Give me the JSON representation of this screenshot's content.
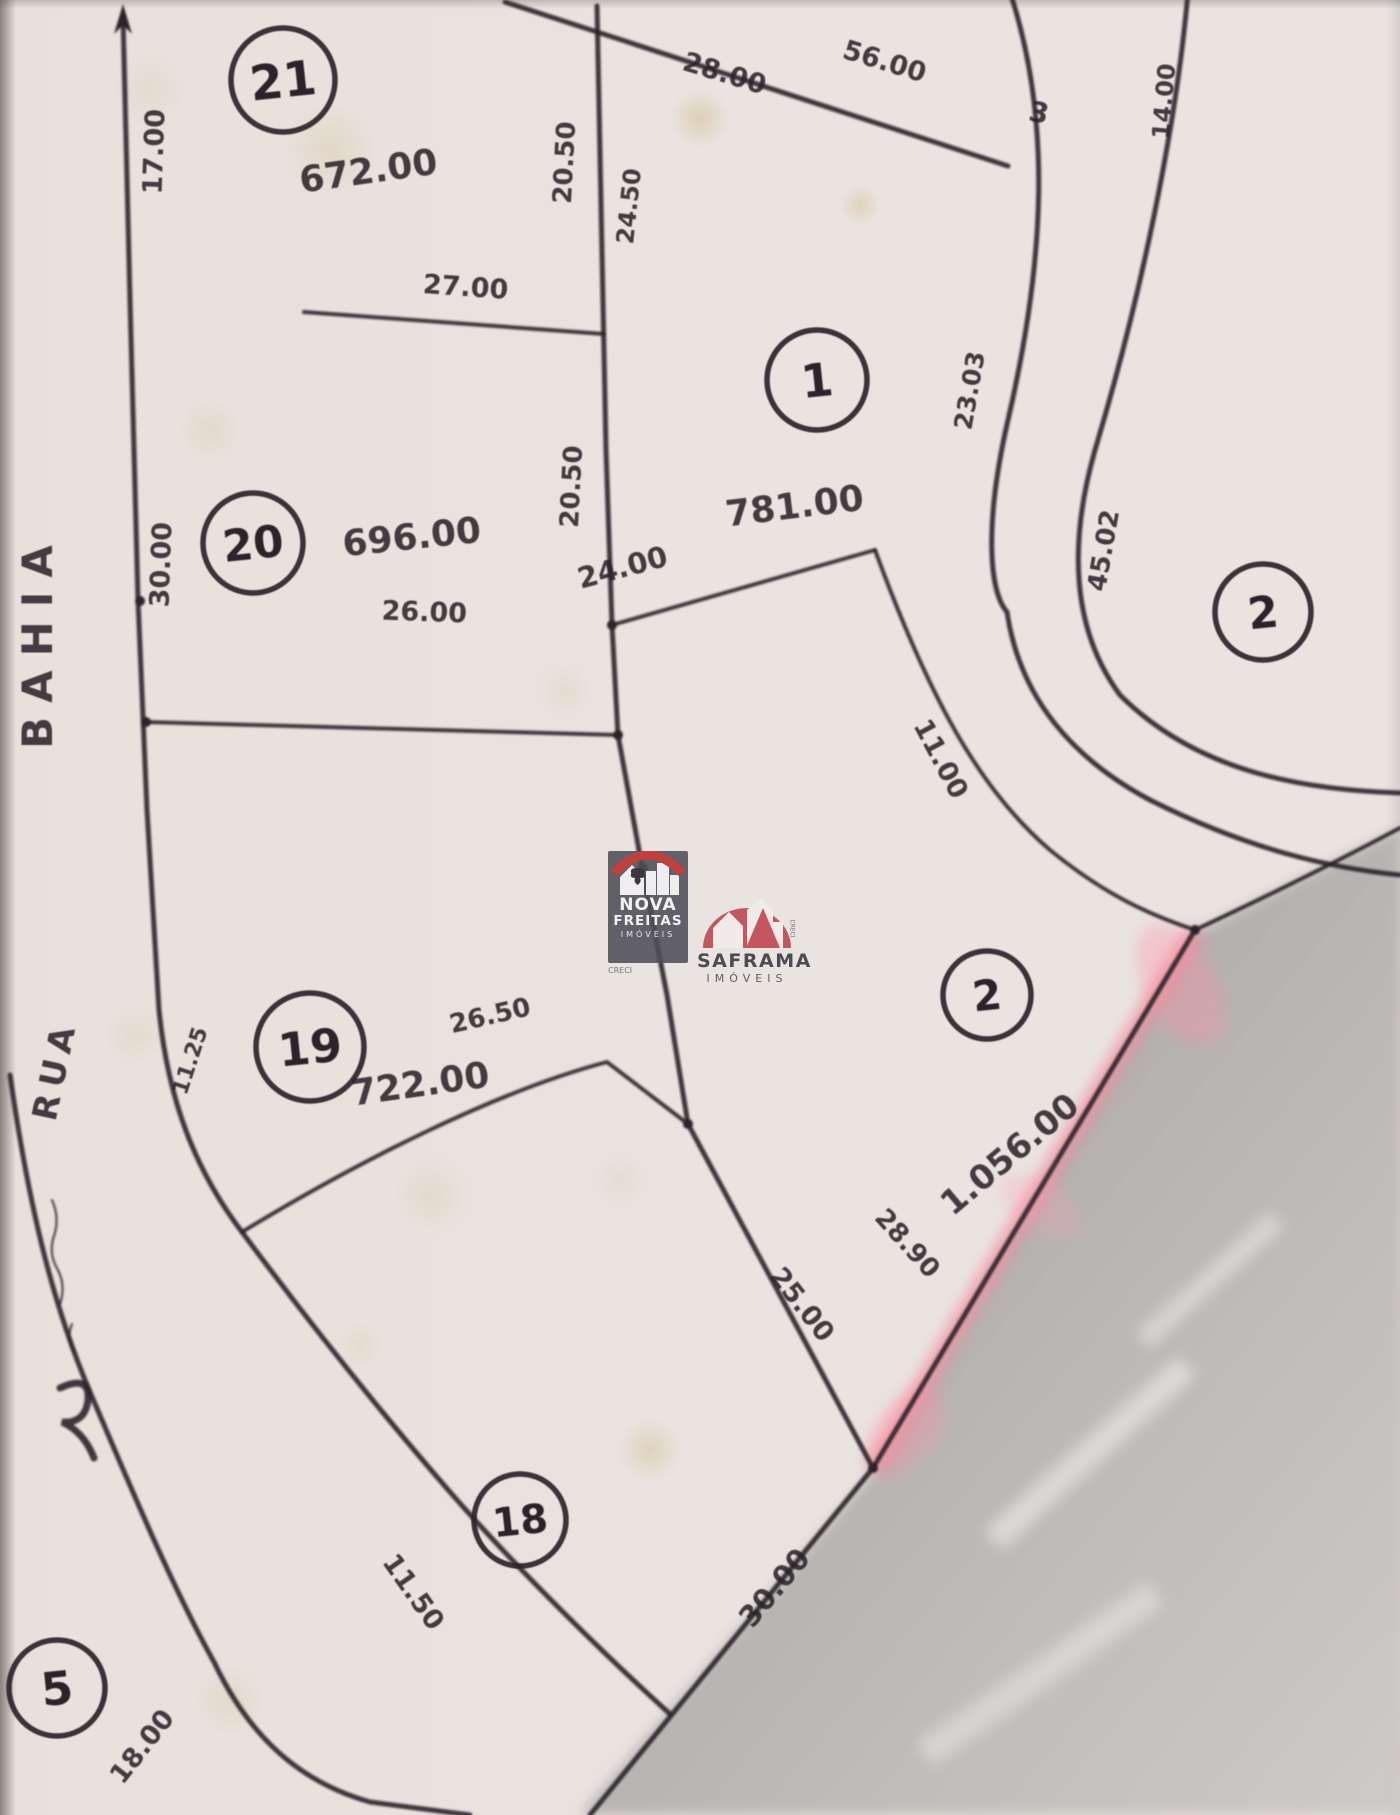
{
  "document": {
    "type": "hand-drawn subdivision plat map (photograph)",
    "ink_color": "#2a242a",
    "paper_color": "#e9e4e0",
    "highlight_pink": "#ff6a86"
  },
  "streets": [
    {
      "label": "BAHIA",
      "x": 52,
      "y": 640,
      "rot": -90,
      "fs": 42,
      "ls": 14
    },
    {
      "label": "RUA",
      "x": 66,
      "y": 1072,
      "rot": -78,
      "fs": 34,
      "ls": 8
    }
  ],
  "lots": [
    {
      "number": "21",
      "cx": 283,
      "cy": 80,
      "r": 52,
      "fs": 48
    },
    {
      "number": "20",
      "cx": 253,
      "cy": 543,
      "r": 50,
      "fs": 44
    },
    {
      "number": "1",
      "cx": 817,
      "cy": 380,
      "r": 50,
      "fs": 46
    },
    {
      "number": "2",
      "cx": 1263,
      "cy": 612,
      "r": 48,
      "fs": 44
    },
    {
      "number": "19",
      "cx": 310,
      "cy": 1047,
      "r": 54,
      "fs": 46
    },
    {
      "number": "2",
      "cx": 987,
      "cy": 995,
      "r": 44,
      "fs": 42
    },
    {
      "number": "18",
      "cx": 520,
      "cy": 1520,
      "r": 46,
      "fs": 40
    },
    {
      "number": "5",
      "cx": 57,
      "cy": 1688,
      "r": 48,
      "fs": 46
    }
  ],
  "area_labels": [
    {
      "t": "672.00",
      "x": 370,
      "y": 183,
      "rot": -8,
      "fs": 36
    },
    {
      "t": "696.00",
      "x": 413,
      "y": 549,
      "rot": -6,
      "fs": 36
    },
    {
      "t": "781.00",
      "x": 796,
      "y": 518,
      "rot": -7,
      "fs": 36
    },
    {
      "t": "722.00",
      "x": 422,
      "y": 1096,
      "rot": -8,
      "fs": 36
    },
    {
      "t": "1.056.00",
      "x": 1017,
      "y": 1163,
      "rot": -40,
      "fs": 34
    }
  ],
  "dimension_labels": [
    {
      "t": "17.00",
      "x": 163,
      "y": 152,
      "rot": -88,
      "fs": 27
    },
    {
      "t": "30.00",
      "x": 170,
      "y": 565,
      "rot": -88,
      "fs": 27
    },
    {
      "t": "27.00",
      "x": 465,
      "y": 296,
      "rot": 4,
      "fs": 27
    },
    {
      "t": "20.50",
      "x": 573,
      "y": 163,
      "rot": -87,
      "fs": 26
    },
    {
      "t": "24.50",
      "x": 637,
      "y": 207,
      "rot": -84,
      "fs": 24
    },
    {
      "t": "20.50",
      "x": 580,
      "y": 487,
      "rot": -87,
      "fs": 26
    },
    {
      "t": "28.00",
      "x": 722,
      "y": 82,
      "rot": 17,
      "fs": 27
    },
    {
      "t": "56.00",
      "x": 882,
      "y": 70,
      "rot": 17,
      "fs": 27
    },
    {
      "t": "26.00",
      "x": 424,
      "y": 621,
      "rot": 2,
      "fs": 27
    },
    {
      "t": "24.00",
      "x": 625,
      "y": 577,
      "rot": -15,
      "fs": 29
    },
    {
      "t": "23.03",
      "x": 978,
      "y": 392,
      "rot": -80,
      "fs": 25
    },
    {
      "t": "45.02",
      "x": 1112,
      "y": 552,
      "rot": -80,
      "fs": 26
    },
    {
      "t": "14.00",
      "x": 1172,
      "y": 102,
      "rot": -85,
      "fs": 24
    },
    {
      "t": "3",
      "x": 1037,
      "y": 122,
      "rot": 12,
      "fs": 28
    },
    {
      "t": "11.00",
      "x": 933,
      "y": 763,
      "rot": 62,
      "fs": 27
    },
    {
      "t": "26.50",
      "x": 492,
      "y": 1024,
      "rot": -13,
      "fs": 26
    },
    {
      "t": "11.25",
      "x": 197,
      "y": 1063,
      "rot": -72,
      "fs": 22
    },
    {
      "t": "25.00",
      "x": 795,
      "y": 1310,
      "rot": 52,
      "fs": 27
    },
    {
      "t": "28.90",
      "x": 901,
      "y": 1249,
      "rot": 48,
      "fs": 26
    },
    {
      "t": "30.00",
      "x": 782,
      "y": 1594,
      "rot": -50,
      "fs": 29
    },
    {
      "t": "11.50",
      "x": 406,
      "y": 1597,
      "rot": 55,
      "fs": 27
    },
    {
      "t": "18.00",
      "x": 149,
      "y": 1752,
      "rot": -52,
      "fs": 27
    }
  ],
  "geometry": {
    "strokes": [
      {
        "d": "M123,16 L130,300 L138,600 L147,810 L159,1010 C168,1100 195,1170 242,1232 C300,1310 370,1400 450,1492 C520,1572 605,1655 670,1714",
        "w": 5
      },
      {
        "d": "M10,1075 C30,1215 55,1310 90,1392 C135,1498 175,1592 214,1662 C250,1738 300,1782 370,1802 L470,1815",
        "w": 5
      },
      {
        "d": "M597,6 L606,450 L612,625 L618,735 L643,872 L667,995 L688,1124",
        "w": 5
      },
      {
        "d": "M146,722 L618,735",
        "w": 4
      },
      {
        "d": "M612,625 L875,550",
        "w": 4
      },
      {
        "d": "M505,2 L720,72 L1008,166",
        "w": 5
      },
      {
        "d": "M304,312 L604,334",
        "w": 4
      },
      {
        "d": "M242,1232 C360,1160 500,1090 607,1062 L688,1124",
        "w": 4
      },
      {
        "d": "M688,1124 L873,1468",
        "w": 5
      },
      {
        "d": "M873,1468 L590,1815",
        "w": 5
      },
      {
        "d": "M875,550 C930,700 980,790 1050,850 C1105,895 1150,915 1195,930",
        "w": 4
      },
      {
        "d": "M1195,930 C1270,895 1340,860 1400,828",
        "w": 4
      },
      {
        "d": "M1010,-8 C1052,120 1045,260 1008,420 C985,520 988,590 1007,612 C1020,700 1075,760 1150,800 C1250,850 1330,868 1400,875",
        "w": 5
      },
      {
        "d": "M1188,-8 C1176,130 1140,300 1095,450 C1068,545 1072,630 1120,695 C1200,775 1310,790 1400,793",
        "w": 5
      },
      {
        "d": "M52,1200 q8,18 2,36 q-6,18 4,34 q8,16 2,34 m12,20 q-6,14 2,28",
        "w": 2
      },
      {
        "d": "M60,1388 q30,-14 28,12 q-3,24 -26,22 q22,10 32,36",
        "w": 7
      }
    ],
    "pink_line": {
      "d": "M873,1468 L1195,930"
    },
    "dark_region": "873,1472 1195,932 1400,828 1400,1815 580,1815",
    "arrow": "123,4 114,34 123,25 132,34",
    "dots": [
      {
        "x": 140,
        "y": 601
      },
      {
        "x": 146,
        "y": 722
      },
      {
        "x": 612,
        "y": 625
      },
      {
        "x": 618,
        "y": 735
      },
      {
        "x": 688,
        "y": 1124
      },
      {
        "x": 873,
        "y": 1468
      },
      {
        "x": 643,
        "y": 868
      },
      {
        "x": 1195,
        "y": 930
      }
    ]
  },
  "watermarks": {
    "nova": {
      "line1": "NOVA",
      "line2": "FREITAS",
      "line3": "IMÓVEIS",
      "creci": "CRECI"
    },
    "saframa": {
      "line1": "SAFRAMA",
      "line2": "IMÓVEIS",
      "creci": "CRECI"
    }
  }
}
